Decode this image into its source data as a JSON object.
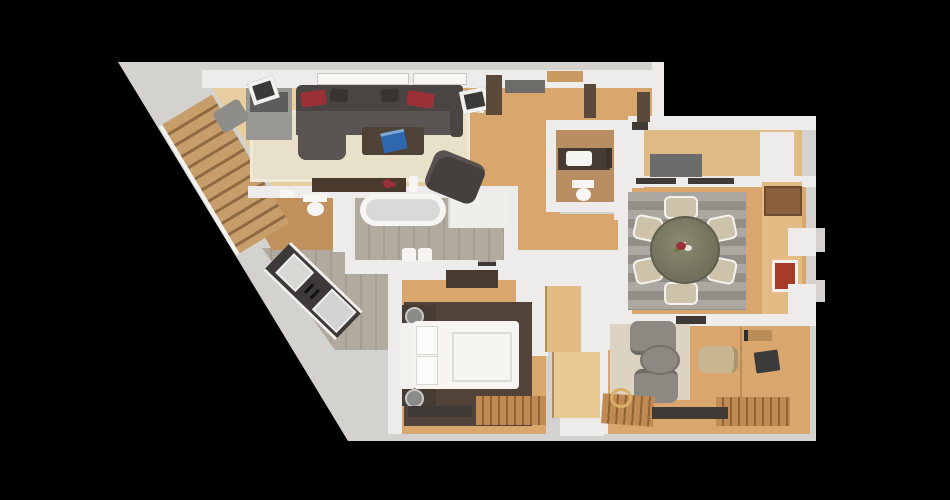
{
  "scene": {
    "type": "3d-floor-plan-top-view",
    "background": "#000000"
  },
  "palette": {
    "base": "#d3d2cf",
    "wall": "#edecea",
    "wallBright": "#f7f6f3",
    "woodGold": "#d9a76d",
    "woodPale": "#e7cda0",
    "woodTR": "#deba85",
    "woodGray": "#b2aa9e",
    "tanFloor": "#c0905d",
    "wcFloor": "#b98e63",
    "rugBeige": "#e9e0c9",
    "rugGray": "#938f88",
    "rugGrayLight": "#aaa8a1",
    "rugDark": "#52433a",
    "rugLight": "#ddd3c2",
    "sofa": "#4a4542",
    "sofaSeat": "#5a5552",
    "pillowRed": "#9c3037",
    "pillowDark": "#37332f",
    "tableDark": "#4e4135",
    "laptopBlue": "#2f66b0",
    "diningTableA": "#8b8b72",
    "diningTableB": "#6f6f5a",
    "chair": "#cdc3ab",
    "pureWhite": "#f6f5f2",
    "frameWhite": "#f2f1ee",
    "woodLight": "#e2bc84",
    "woodLighter": "#e9c994",
    "counter": "#3c3938",
    "metal": "#d8d7d4",
    "armGray": "#8d8882",
    "chairBeige": "#c9b690",
    "slatWood": "#c08a52",
    "slatDark": "#8f6336",
    "runnerDark": "#3f3a35",
    "brownWall": "#5b4a3a",
    "dresserBrown": "#8a5f3c",
    "brickRed": "#a53c28",
    "grayUnit": "#6b6b6b",
    "cabinetGray": "#9a9894",
    "cabinetDark": "#5f5d5b",
    "lampSilver": "#c9c9c7",
    "tubInner": "#d9dad8",
    "vanityDark": "#473c33",
    "stairWood": "#c79e6a",
    "stairGap": "#8f6a42"
  },
  "inventory": {
    "rooms": [
      {
        "id": "living-room",
        "furniture": [
          "sectional-sofa",
          "chaise",
          "red-pillows",
          "coffee-table",
          "laptop",
          "area-rug",
          "tv-cabinet",
          "bench",
          "console-table",
          "flowers",
          "candle",
          "armchair",
          "wall-art-left",
          "wall-art-right",
          "windows"
        ]
      },
      {
        "id": "staircase",
        "furniture": [
          "wood-steps",
          "railing"
        ]
      },
      {
        "id": "entry-hall",
        "furniture": [
          "wall-art",
          "console-shelf",
          "dark-wall-panels",
          "door-lintel"
        ]
      },
      {
        "id": "kitchen",
        "furniture": [
          "angled-counter",
          "sink",
          "cooktop"
        ]
      },
      {
        "id": "powder-room",
        "furniture": [
          "toilet",
          "small-sink"
        ]
      },
      {
        "id": "bathroom",
        "furniture": [
          "bathtub",
          "faucet",
          "vanity",
          "bin",
          "bin"
        ]
      },
      {
        "id": "wc",
        "furniture": [
          "vanity-sink",
          "toilet",
          "shelf"
        ]
      },
      {
        "id": "hallway",
        "furniture": []
      },
      {
        "id": "bedroom",
        "furniture": [
          "double-bed",
          "headboard",
          "pillows",
          "nightstand",
          "nightstand",
          "spiral-lamp",
          "spiral-lamp",
          "tv-panel",
          "dark-rug",
          "closet-upper",
          "closet-lower",
          "slatted-mat",
          "dark-runner"
        ]
      },
      {
        "id": "dining-room",
        "furniture": [
          "round-table",
          "centerpiece-flowers",
          "dining-chair-x6",
          "striped-rug",
          "corner-dresser",
          "wall-cabinets",
          "red-panel"
        ]
      },
      {
        "id": "walk-in-room",
        "furniture": [
          "dark-unit",
          "white-closet"
        ]
      },
      {
        "id": "study",
        "furniture": [
          "armchair",
          "armchair",
          "ottoman",
          "light-rug",
          "office-chair",
          "desk",
          "laptop",
          "slatted-mat",
          "slatted-mat",
          "dark-runner",
          "gold-ring"
        ]
      }
    ]
  }
}
